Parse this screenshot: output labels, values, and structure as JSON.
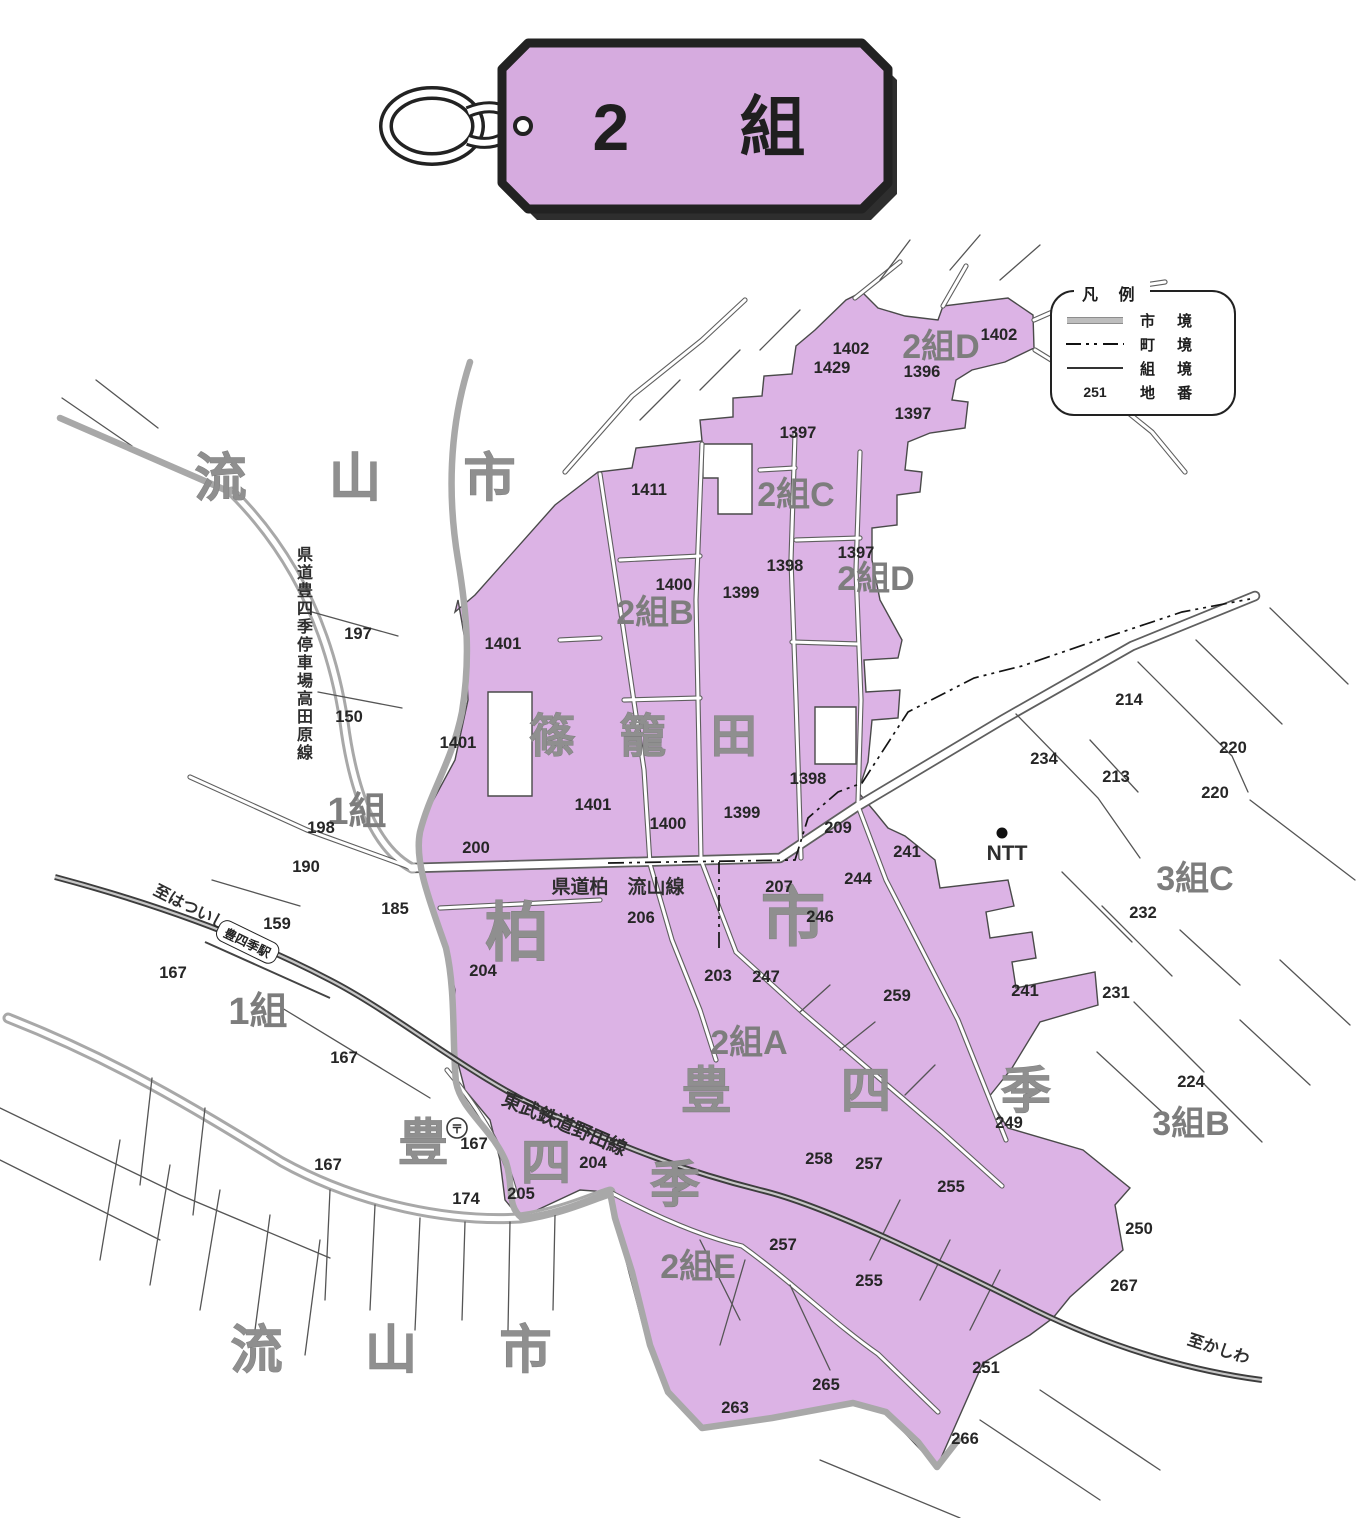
{
  "tag": {
    "title": "2 組"
  },
  "legend": {
    "title": "凡 例",
    "items": [
      {
        "label": "市 境",
        "sample": "city"
      },
      {
        "label": "町 境",
        "sample": "town"
      },
      {
        "label": "組 境",
        "sample": "kumi"
      },
      {
        "label": "地 番",
        "sample": "num",
        "value": "251"
      }
    ]
  },
  "colors": {
    "region_fill": "#dcb3e5",
    "tag_fill": "#d6abdf",
    "boundary_gray": "#a8a8a8",
    "railway_dark": "#3d3d3d"
  },
  "map": {
    "station": "豊四季駅",
    "labels": [
      {
        "t": "流 山 市",
        "x": 372,
        "y": 496,
        "s": 52,
        "sp": 34,
        "k": "area",
        "n": "city-name-nagareyama-top"
      },
      {
        "t": "流 山 市",
        "x": 408,
        "y": 1368,
        "s": 52,
        "sp": 34,
        "k": "area",
        "n": "city-name-nagareyama-bottom"
      },
      {
        "t": "柏",
        "x": 517,
        "y": 955,
        "s": 64,
        "k": "area",
        "n": "city-name-kashiwa-1"
      },
      {
        "t": "市",
        "x": 793,
        "y": 940,
        "s": 64,
        "k": "area",
        "n": "city-name-kashiwa-2"
      },
      {
        "t": "篠 籠 田",
        "x": 651,
        "y": 752,
        "s": 46,
        "sp": 16,
        "k": "area",
        "n": "district-shinoda"
      },
      {
        "t": "豊 四 季",
        "x": 890,
        "y": 1108,
        "s": 50,
        "sp": 48,
        "k": "area",
        "n": "district-toyoshiki"
      },
      {
        "t": "豊",
        "x": 423,
        "y": 1160,
        "s": 50,
        "k": "area",
        "n": "district-toyoshiki-char1"
      },
      {
        "t": "四",
        "x": 546,
        "y": 1180,
        "s": 50,
        "k": "area",
        "n": "district-toyoshiki-char2"
      },
      {
        "t": "季",
        "x": 675,
        "y": 1202,
        "s": 50,
        "k": "area",
        "n": "district-toyoshiki-char3"
      },
      {
        "t": "1組",
        "x": 357,
        "y": 824,
        "s": 38,
        "k": "group",
        "n": "group-1-label-top"
      },
      {
        "t": "1組",
        "x": 258,
        "y": 1024,
        "s": 38,
        "k": "group",
        "n": "group-1-label-bottom"
      },
      {
        "t": "2組B",
        "x": 655,
        "y": 624,
        "s": 34,
        "k": "group",
        "n": "group-2b-label"
      },
      {
        "t": "2組C",
        "x": 796,
        "y": 506,
        "s": 34,
        "k": "group",
        "n": "group-2c-label"
      },
      {
        "t": "2組D",
        "x": 941,
        "y": 358,
        "s": 34,
        "k": "group",
        "n": "group-2d-label-top"
      },
      {
        "t": "2組D",
        "x": 876,
        "y": 590,
        "s": 34,
        "k": "group",
        "n": "group-2d-label-mid"
      },
      {
        "t": "2組A",
        "x": 749,
        "y": 1054,
        "s": 34,
        "k": "group",
        "n": "group-2a-label"
      },
      {
        "t": "2組E",
        "x": 698,
        "y": 1278,
        "s": 34,
        "k": "group",
        "n": "group-2e-label"
      },
      {
        "t": "3組C",
        "x": 1195,
        "y": 890,
        "s": 34,
        "k": "group",
        "n": "group-3c-label"
      },
      {
        "t": "3組B",
        "x": 1191,
        "y": 1135,
        "s": 34,
        "k": "group",
        "n": "group-3b-label"
      },
      {
        "t": "NTT",
        "x": 1007,
        "y": 860,
        "s": 21,
        "k": "road",
        "n": "ntt-label"
      },
      {
        "t": "〒",
        "x": 457,
        "y": 1133,
        "s": 12,
        "k": "road",
        "n": "post-office-symbol"
      },
      {
        "t": "県道柏　流山線",
        "x": 618,
        "y": 893,
        "s": 19,
        "k": "road",
        "n": "road-name-kashiwa-nagareyama"
      },
      {
        "t": "東武鉄道野田線",
        "x": 562,
        "y": 1130,
        "s": 19,
        "r": 23,
        "k": "road",
        "n": "railway-name-tobu-noda"
      },
      {
        "t": "至はついし",
        "x": 188,
        "y": 912,
        "s": 16,
        "r": 27,
        "k": "road",
        "n": "to-hatsuishi"
      },
      {
        "t": "至かしわ",
        "x": 1217,
        "y": 1354,
        "s": 16,
        "r": 18,
        "k": "road",
        "n": "to-kashiwa"
      },
      {
        "t": "県道豊四季停車場高田原線",
        "x": 305,
        "y": 560,
        "s": 16,
        "v": 1,
        "k": "road",
        "n": "road-name-toyoshiki-takadahara"
      },
      {
        "t": "1402",
        "x": 851,
        "y": 354,
        "k": "num"
      },
      {
        "t": "1402",
        "x": 999,
        "y": 340,
        "k": "num"
      },
      {
        "t": "1429",
        "x": 832,
        "y": 373,
        "k": "num"
      },
      {
        "t": "1396",
        "x": 922,
        "y": 377,
        "k": "num"
      },
      {
        "t": "1397",
        "x": 913,
        "y": 419,
        "k": "num"
      },
      {
        "t": "1397",
        "x": 798,
        "y": 438,
        "k": "num"
      },
      {
        "t": "1397",
        "x": 856,
        "y": 558,
        "k": "num"
      },
      {
        "t": "1398",
        "x": 785,
        "y": 571,
        "k": "num"
      },
      {
        "t": "1399",
        "x": 741,
        "y": 598,
        "k": "num"
      },
      {
        "t": "1411",
        "x": 649,
        "y": 495,
        "k": "num"
      },
      {
        "t": "1400",
        "x": 674,
        "y": 590,
        "k": "num"
      },
      {
        "t": "1401",
        "x": 503,
        "y": 649,
        "k": "num"
      },
      {
        "t": "1401",
        "x": 458,
        "y": 748,
        "k": "num"
      },
      {
        "t": "1401",
        "x": 593,
        "y": 810,
        "k": "num"
      },
      {
        "t": "1400",
        "x": 668,
        "y": 829,
        "k": "num"
      },
      {
        "t": "1399",
        "x": 742,
        "y": 818,
        "k": "num"
      },
      {
        "t": "1398",
        "x": 808,
        "y": 784,
        "k": "num"
      },
      {
        "t": "209",
        "x": 838,
        "y": 833,
        "k": "num"
      },
      {
        "t": "200",
        "x": 476,
        "y": 853,
        "k": "num"
      },
      {
        "t": "197",
        "x": 358,
        "y": 639,
        "k": "num"
      },
      {
        "t": "150",
        "x": 349,
        "y": 722,
        "k": "num"
      },
      {
        "t": "198",
        "x": 321,
        "y": 833,
        "k": "num"
      },
      {
        "t": "190",
        "x": 306,
        "y": 872,
        "k": "num"
      },
      {
        "t": "185",
        "x": 395,
        "y": 914,
        "k": "num"
      },
      {
        "t": "159",
        "x": 277,
        "y": 929,
        "k": "num"
      },
      {
        "t": "167",
        "x": 173,
        "y": 978,
        "k": "num"
      },
      {
        "t": "167",
        "x": 344,
        "y": 1063,
        "k": "num"
      },
      {
        "t": "167",
        "x": 328,
        "y": 1170,
        "k": "num"
      },
      {
        "t": "167",
        "x": 474,
        "y": 1149,
        "k": "num"
      },
      {
        "t": "174",
        "x": 466,
        "y": 1204,
        "k": "num"
      },
      {
        "t": "205",
        "x": 521,
        "y": 1199,
        "k": "num"
      },
      {
        "t": "204",
        "x": 593,
        "y": 1168,
        "k": "num"
      },
      {
        "t": "204",
        "x": 483,
        "y": 976,
        "k": "num"
      },
      {
        "t": "206",
        "x": 641,
        "y": 923,
        "k": "num"
      },
      {
        "t": "207",
        "x": 779,
        "y": 892,
        "k": "num"
      },
      {
        "t": "246",
        "x": 820,
        "y": 922,
        "k": "num"
      },
      {
        "t": "203",
        "x": 718,
        "y": 981,
        "k": "num"
      },
      {
        "t": "247",
        "x": 766,
        "y": 982,
        "k": "num"
      },
      {
        "t": "259",
        "x": 897,
        "y": 1001,
        "k": "num"
      },
      {
        "t": "241",
        "x": 1025,
        "y": 996,
        "k": "num"
      },
      {
        "t": "241",
        "x": 907,
        "y": 857,
        "k": "num"
      },
      {
        "t": "244",
        "x": 858,
        "y": 884,
        "k": "num"
      },
      {
        "t": "249",
        "x": 1009,
        "y": 1128,
        "k": "num"
      },
      {
        "t": "258",
        "x": 819,
        "y": 1164,
        "k": "num"
      },
      {
        "t": "257",
        "x": 869,
        "y": 1169,
        "k": "num"
      },
      {
        "t": "255",
        "x": 951,
        "y": 1192,
        "k": "num"
      },
      {
        "t": "257",
        "x": 783,
        "y": 1250,
        "k": "num"
      },
      {
        "t": "255",
        "x": 869,
        "y": 1286,
        "k": "num"
      },
      {
        "t": "251",
        "x": 986,
        "y": 1373,
        "k": "num"
      },
      {
        "t": "265",
        "x": 826,
        "y": 1390,
        "k": "num"
      },
      {
        "t": "263",
        "x": 735,
        "y": 1413,
        "k": "num"
      },
      {
        "t": "266",
        "x": 965,
        "y": 1444,
        "k": "num"
      },
      {
        "t": "250",
        "x": 1139,
        "y": 1234,
        "k": "num"
      },
      {
        "t": "267",
        "x": 1124,
        "y": 1291,
        "k": "num"
      },
      {
        "t": "232",
        "x": 1143,
        "y": 918,
        "k": "num"
      },
      {
        "t": "231",
        "x": 1116,
        "y": 998,
        "k": "num"
      },
      {
        "t": "224",
        "x": 1191,
        "y": 1087,
        "k": "num"
      },
      {
        "t": "213",
        "x": 1116,
        "y": 782,
        "k": "num"
      },
      {
        "t": "214",
        "x": 1129,
        "y": 705,
        "k": "num"
      },
      {
        "t": "220",
        "x": 1233,
        "y": 753,
        "k": "num"
      },
      {
        "t": "220",
        "x": 1215,
        "y": 798,
        "k": "num"
      },
      {
        "t": "234",
        "x": 1044,
        "y": 764,
        "k": "num"
      }
    ]
  }
}
